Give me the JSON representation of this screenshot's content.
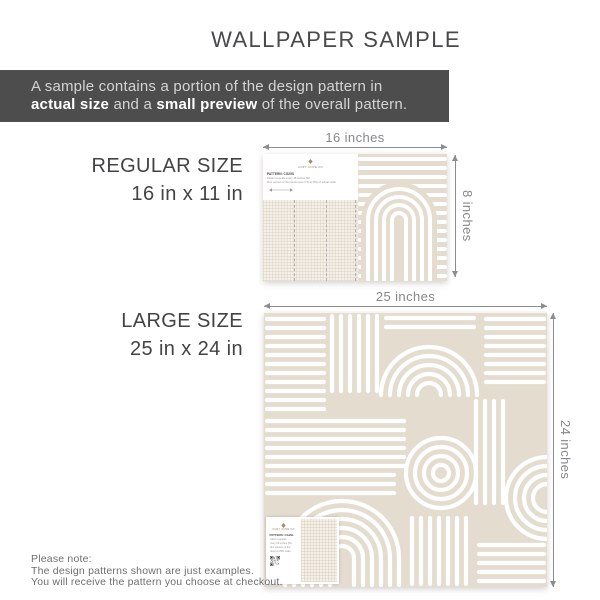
{
  "page": {
    "title": "WALLPAPER SAMPLE"
  },
  "banner": {
    "line1": "A sample contains a portion of the design pattern in",
    "bold1": "actual size",
    "mid": " and a ",
    "bold2": "small preview",
    "end": " of the overall pattern."
  },
  "regular": {
    "size_name": "REGULAR SIZE",
    "size_dims": "16 in x 11 in",
    "width_label": "16 inches",
    "height_label": "8 inches",
    "card": {
      "brand": "COZY COVE CO",
      "pattern_code": "PATTERN: CG29S",
      "note1": "Pattern repeats every 26 inches (W).",
      "note2": "Mini version of the panels (set of 3) at 25% of actual scale."
    }
  },
  "large": {
    "size_name": "LARGE SIZE",
    "size_dims": "25 in x 24 in",
    "width_label": "25 inches",
    "height_label": "24 inches",
    "card": {
      "brand": "COZY COVE CO",
      "pattern_code": "PATTERN: CG29L",
      "note1": "Pattern repeats",
      "note2": "every 26 inches (W).",
      "note3": "Mini preview of the",
      "note4": "panel at 25% scale."
    }
  },
  "footer": {
    "line1": "Please note:",
    "line2": "The design patterns shown are just examples.",
    "line3": "You will receive the pattern you choose at checkout."
  },
  "colors": {
    "pattern_beige": "#e4dccf",
    "banner_bg": "#4d4d4d",
    "logo_accent": "#a98963",
    "dimension_gray": "#8b8d90"
  }
}
